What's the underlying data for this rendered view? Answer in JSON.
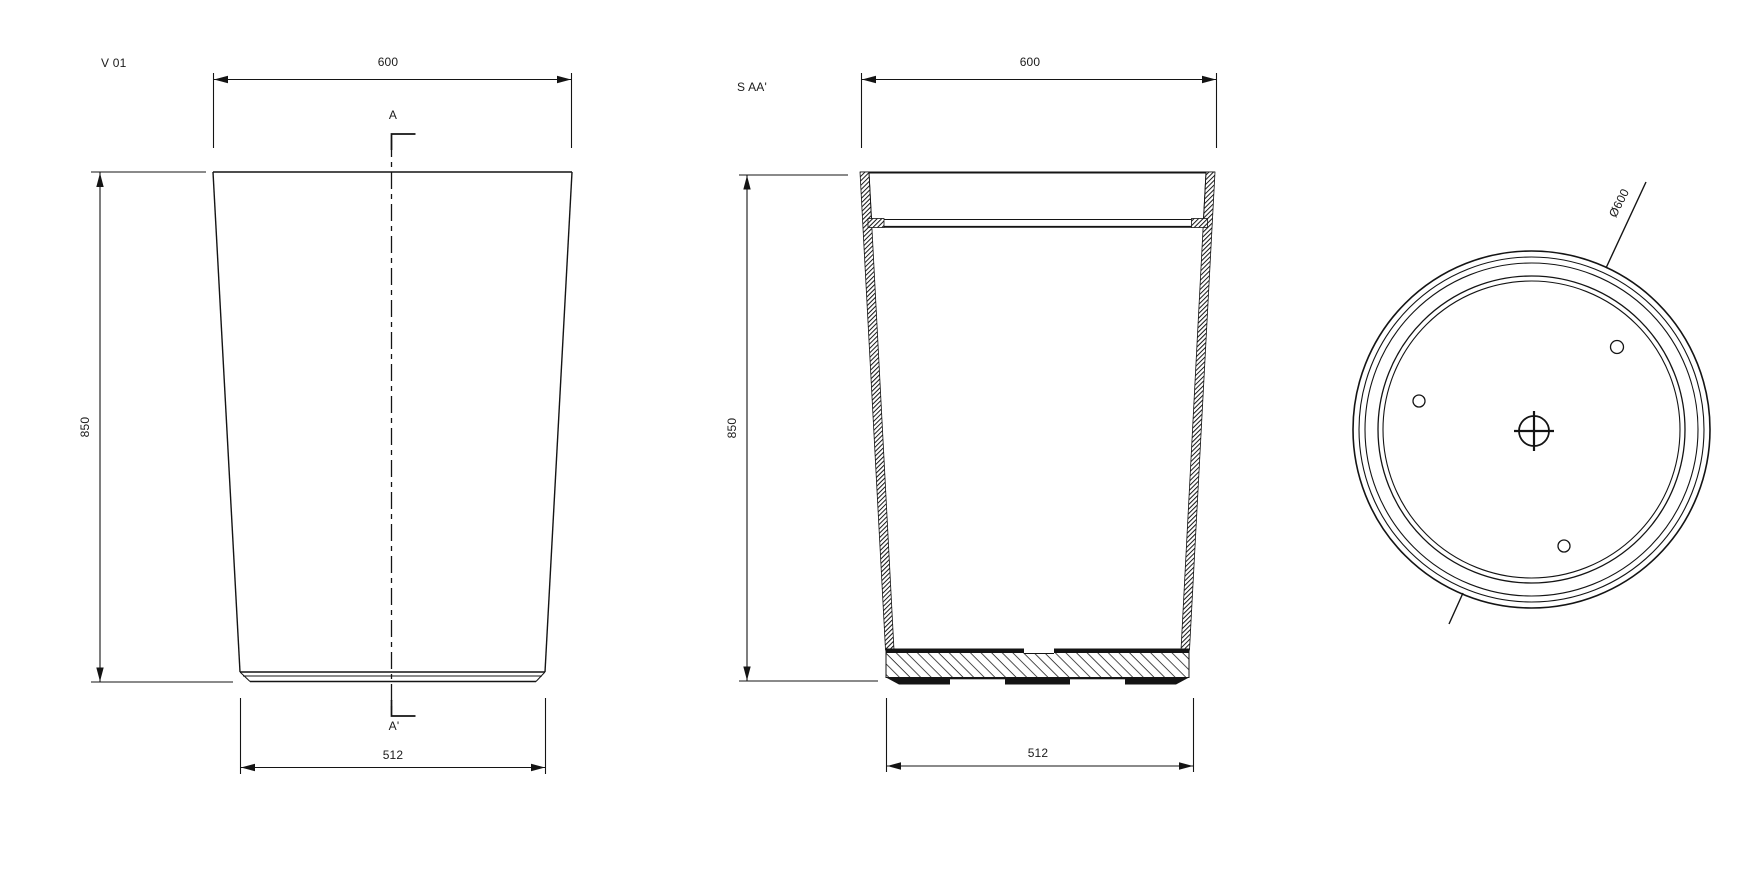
{
  "drawing": {
    "background_color": "#ffffff",
    "line_color": "#141414",
    "views": {
      "front": {
        "label": "V 01",
        "section_marker_top": "A",
        "section_marker_bottom": "A'",
        "dims": {
          "top_width": "600",
          "height": "850",
          "bottom_width": "512"
        }
      },
      "section": {
        "label": "S AA'",
        "dims": {
          "top_width": "600",
          "height": "850",
          "bottom_width": "512"
        }
      },
      "plan": {
        "dims": {
          "diameter": "Ø600"
        }
      }
    }
  }
}
